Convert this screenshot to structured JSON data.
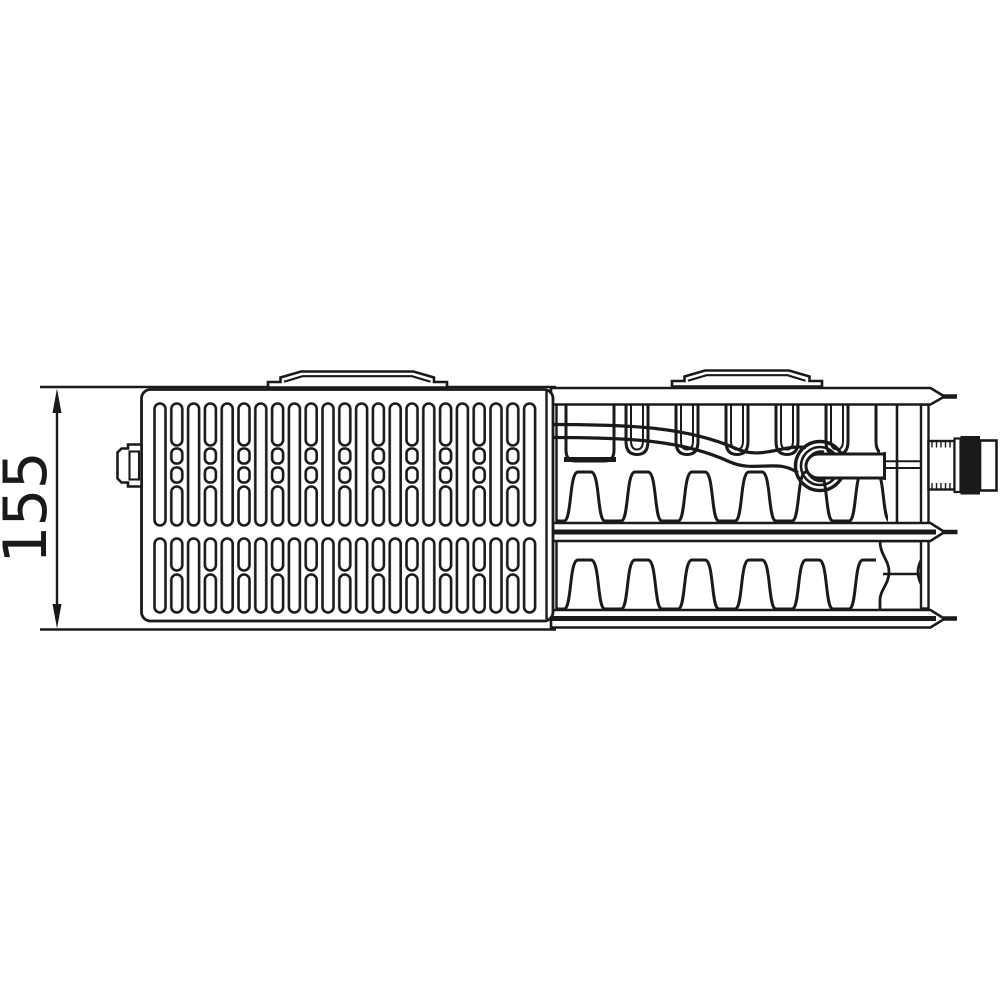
{
  "drawing": {
    "dimension_label": "155",
    "colors": {
      "line": "#1a1a1a",
      "background": "#ffffff",
      "fitting_block": "#1a1a1a"
    }
  }
}
